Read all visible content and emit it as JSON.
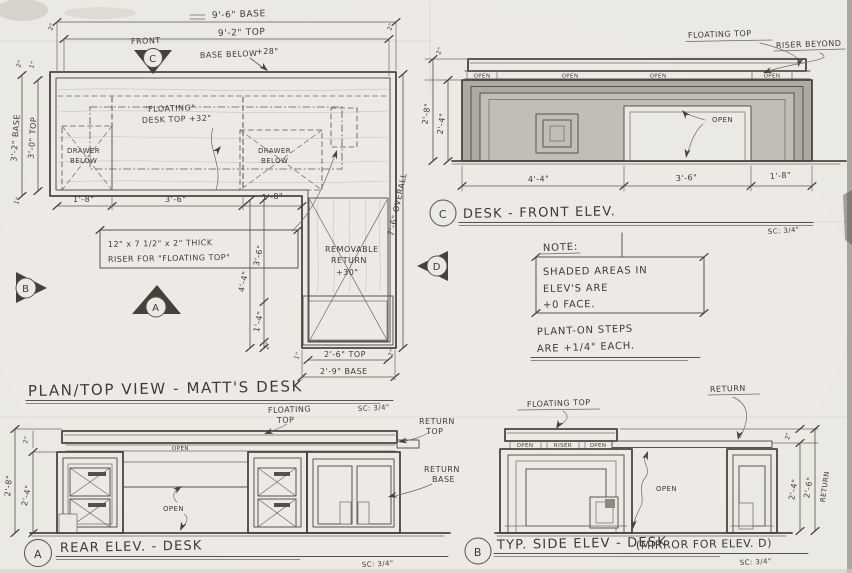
{
  "colors": {
    "paper": "#ebe9e3",
    "pencil": "#57524b",
    "shade": "#b0aba3",
    "dark": "#45413a"
  },
  "common": {
    "in1": "1\"",
    "in2": "2\""
  },
  "plan": {
    "title": "PLAN/TOP VIEW - MATT'S DESK",
    "scale": "SC: 3/4\"",
    "markers": {
      "a": "A",
      "b": "B",
      "c": "C",
      "d": "D"
    },
    "labels": {
      "front": "FRONT",
      "base_below": "BASE BELOW",
      "base_below_val": "+28\"",
      "floating_1": "\"FLOATING\"",
      "floating_2": "DESK TOP +32\"",
      "drawer_1": "DRAWER",
      "drawer_2": "BELOW",
      "riser_note_1": "12\" x 7 1/2\" x 2\" THICK",
      "riser_note_2": "RISER FOR \"FLOATING TOP\"",
      "removable_1": "REMOVABLE",
      "removable_2": "RETURN",
      "removable_3": "+30\""
    },
    "dims": {
      "base_width": "9'-6\" BASE",
      "top_width": "9'-2\" TOP",
      "left_base": "3'-2\" BASE",
      "left_top": "3'-0\" TOP",
      "bottom_left": "1'-8\"",
      "bottom_mid": "3'-6\"",
      "bottom_right": "1'-8\"",
      "return_top": "2'-6\" TOP",
      "return_base": "2'-9\" BASE",
      "return_overall": "4'-4\"",
      "return_upper": "3'-6\"",
      "return_lower": "1'-4\"",
      "overall_depth": "7'-6\" OVERALL"
    }
  },
  "front_elev": {
    "marker": "C",
    "title": "DESK - FRONT ELEV.",
    "scale": "SC: 3/4\"",
    "labels": {
      "floating_top": "FLOATING TOP",
      "riser_beyond": "RISER BEYOND",
      "open": "OPEN"
    },
    "dims": {
      "left_outer": "2'-8\"",
      "left_inner": "2'-4\"",
      "bottom_left": "4'-4\"",
      "bottom_mid": "3'-6\"",
      "bottom_right": "1'-8\""
    }
  },
  "note": {
    "heading": "NOTE:",
    "box_lines": [
      "SHADED AREAS IN",
      "ELEV'S ARE",
      "+0 FACE."
    ],
    "steps_1": "PLANT-ON STEPS",
    "steps_2": "ARE +1/4\" EACH."
  },
  "rear_elev": {
    "marker": "A",
    "title": "REAR ELEV. - DESK",
    "scale": "SC: 3/4\"",
    "labels": {
      "floating_1": "FLOATING",
      "floating_2": "TOP",
      "return_top_1": "RETURN",
      "return_top_2": "TOP",
      "return_base_1": "RETURN",
      "return_base_2": "BASE",
      "open": "OPEN"
    },
    "dims": {
      "outer": "2'-8\"",
      "inner": "2'-4\""
    }
  },
  "side_elev": {
    "marker": "B",
    "title": "TYP. SIDE ELEV - DESK",
    "mirror": "(MIRROR FOR ELEV. D)",
    "scale": "SC: 3/4\"",
    "labels": {
      "floating_top": "FLOATING TOP",
      "return": "RETURN",
      "open": "OPEN",
      "riser": "RISER",
      "return_vert": "RETURN"
    },
    "dims": {
      "inner": "2'-4\"",
      "outer": "2'-6\""
    }
  }
}
